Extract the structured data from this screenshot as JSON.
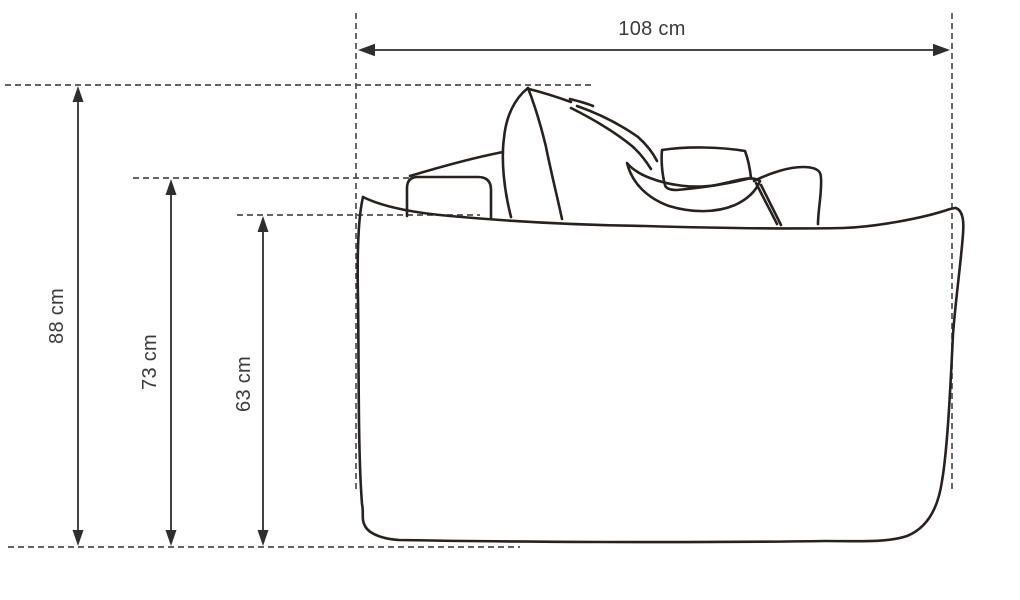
{
  "figure": {
    "type": "furniture-dimension-diagram",
    "subject": "sofa side view line drawing",
    "unit": "cm",
    "dimensions": {
      "width": {
        "label": "108 cm",
        "value": 108,
        "orientation": "horizontal"
      },
      "overall_height": {
        "label": "88 cm",
        "value": 88,
        "orientation": "vertical"
      },
      "back_height": {
        "label": "73 cm",
        "value": 73,
        "orientation": "vertical"
      },
      "seat_front_height": {
        "label": "63 cm",
        "value": 63,
        "orientation": "vertical"
      }
    },
    "colors": {
      "outline": "#27221f",
      "dimension": "#2e2e2e",
      "dashed": "#4f4f4f",
      "label": "#3b3b3b",
      "background": "#ffffff"
    }
  }
}
